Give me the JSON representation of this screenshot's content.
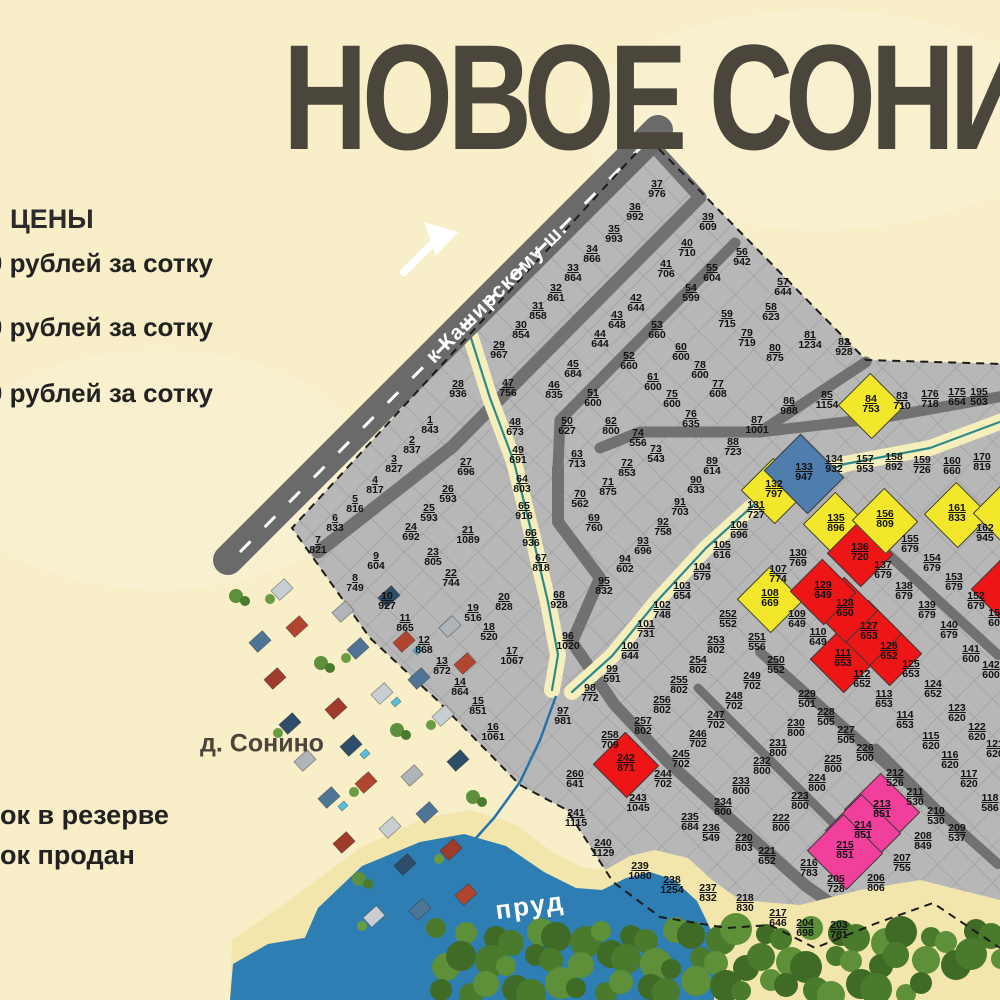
{
  "title": "НОВОЕ СОНИНО",
  "legend": {
    "heading": "ЦЕНЫ",
    "price_lines": [
      "00 рублей за сотку",
      "00 рублей за сотку",
      "0 рублей за сотку"
    ],
    "status_lines": [
      "ок в резерве",
      "ок продан"
    ]
  },
  "map_labels": {
    "road": "к Каширскому ш.",
    "village": "д. Сонино",
    "pond": "пруд"
  },
  "plot_colors": {
    "g": "#b7b7b7",
    "y": "#f2e72b",
    "r": "#ed1515",
    "b": "#4f7dad",
    "p": "#f0409c"
  },
  "edge_shards": [
    [
      1004,
      588,
      "r"
    ],
    [
      1006,
      512,
      "y"
    ]
  ],
  "plots": [
    [
      "1",
      "843",
      430,
      425
    ],
    [
      "2",
      "837",
      412,
      445
    ],
    [
      "3",
      "827",
      394,
      464
    ],
    [
      "4",
      "817",
      375,
      485
    ],
    [
      "5",
      "816",
      355,
      504
    ],
    [
      "6",
      "833",
      335,
      523
    ],
    [
      "7",
      "821",
      318,
      545
    ],
    [
      "8",
      "749",
      355,
      583
    ],
    [
      "9",
      "604",
      376,
      561
    ],
    [
      "10",
      "927",
      387,
      601
    ],
    [
      "11",
      "865",
      405,
      623
    ],
    [
      "12",
      "868",
      424,
      645
    ],
    [
      "13",
      "872",
      442,
      666
    ],
    [
      "14",
      "864",
      460,
      687
    ],
    [
      "15",
      "851",
      478,
      706
    ],
    [
      "16",
      "1061",
      493,
      732
    ],
    [
      "17",
      "1067",
      512,
      656
    ],
    [
      "18",
      "520",
      489,
      632
    ],
    [
      "19",
      "516",
      473,
      613
    ],
    [
      "20",
      "828",
      504,
      602
    ],
    [
      "21",
      "1089",
      468,
      535
    ],
    [
      "22",
      "744",
      451,
      578
    ],
    [
      "23",
      "805",
      433,
      557
    ],
    [
      "24",
      "692",
      411,
      532
    ],
    [
      "25",
      "593",
      429,
      513
    ],
    [
      "26",
      "593",
      448,
      494
    ],
    [
      "27",
      "696",
      466,
      467
    ],
    [
      "28",
      "936",
      458,
      389
    ],
    [
      "29",
      "967",
      499,
      350
    ],
    [
      "30",
      "854",
      521,
      330
    ],
    [
      "31",
      "858",
      538,
      311
    ],
    [
      "32",
      "861",
      556,
      293
    ],
    [
      "33",
      "864",
      573,
      273
    ],
    [
      "34",
      "866",
      592,
      254
    ],
    [
      "35",
      "993",
      614,
      234
    ],
    [
      "36",
      "992",
      635,
      212
    ],
    [
      "37",
      "976",
      657,
      189
    ],
    [
      "39",
      "609",
      708,
      222
    ],
    [
      "40",
      "710",
      687,
      248
    ],
    [
      "41",
      "706",
      666,
      269
    ],
    [
      "42",
      "644",
      636,
      303
    ],
    [
      "43",
      "648",
      617,
      320
    ],
    [
      "44",
      "644",
      600,
      339
    ],
    [
      "45",
      "684",
      573,
      369
    ],
    [
      "46",
      "835",
      554,
      390
    ],
    [
      "47",
      "756",
      508,
      388
    ],
    [
      "48",
      "673",
      515,
      427
    ],
    [
      "49",
      "691",
      518,
      455
    ],
    [
      "50",
      "627",
      567,
      426
    ],
    [
      "51",
      "600",
      593,
      398
    ],
    [
      "52",
      "660",
      629,
      361
    ],
    [
      "53",
      "660",
      657,
      330
    ],
    [
      "54",
      "599",
      691,
      293
    ],
    [
      "55",
      "604",
      712,
      273
    ],
    [
      "56",
      "942",
      742,
      257
    ],
    [
      "57",
      "644",
      783,
      287
    ],
    [
      "58",
      "623",
      771,
      312
    ],
    [
      "59",
      "715",
      727,
      319
    ],
    [
      "60",
      "600",
      681,
      352
    ],
    [
      "61",
      "600",
      653,
      382
    ],
    [
      "62",
      "800",
      611,
      426
    ],
    [
      "63",
      "713",
      577,
      459
    ],
    [
      "64",
      "803",
      522,
      484
    ],
    [
      "65",
      "916",
      524,
      511
    ],
    [
      "66",
      "936",
      531,
      538
    ],
    [
      "67",
      "818",
      541,
      563
    ],
    [
      "68",
      "928",
      559,
      600
    ],
    [
      "69",
      "760",
      594,
      523
    ],
    [
      "70",
      "562",
      580,
      499
    ],
    [
      "71",
      "875",
      608,
      487
    ],
    [
      "72",
      "853",
      627,
      468
    ],
    [
      "73",
      "543",
      656,
      454
    ],
    [
      "74",
      "556",
      638,
      438
    ],
    [
      "75",
      "600",
      672,
      399
    ],
    [
      "76",
      "635",
      691,
      419
    ],
    [
      "77",
      "608",
      718,
      389
    ],
    [
      "78",
      "600",
      700,
      370
    ],
    [
      "79",
      "719",
      747,
      338
    ],
    [
      "80",
      "875",
      775,
      353
    ],
    [
      "81",
      "1234",
      810,
      340
    ],
    [
      "82",
      "928",
      844,
      347
    ],
    [
      "83",
      "710",
      902,
      401
    ],
    [
      "84",
      "753",
      871,
      404,
      "y"
    ],
    [
      "85",
      "1154",
      827,
      400
    ],
    [
      "86",
      "988",
      789,
      406
    ],
    [
      "87",
      "1001",
      757,
      425
    ],
    [
      "88",
      "723",
      733,
      447
    ],
    [
      "89",
      "614",
      712,
      466
    ],
    [
      "90",
      "633",
      696,
      485
    ],
    [
      "91",
      "703",
      680,
      507
    ],
    [
      "92",
      "758",
      663,
      527
    ],
    [
      "93",
      "696",
      643,
      546
    ],
    [
      "94",
      "602",
      625,
      564
    ],
    [
      "95",
      "832",
      604,
      586
    ],
    [
      "96",
      "1020",
      568,
      641
    ],
    [
      "97",
      "981",
      563,
      716
    ],
    [
      "98",
      "772",
      590,
      693
    ],
    [
      "99",
      "591",
      612,
      674
    ],
    [
      "100",
      "644",
      630,
      651
    ],
    [
      "101",
      "731",
      646,
      629
    ],
    [
      "102",
      "748",
      662,
      610
    ],
    [
      "103",
      "654",
      682,
      591
    ],
    [
      "104",
      "579",
      702,
      572
    ],
    [
      "105",
      "616",
      722,
      550
    ],
    [
      "106",
      "696",
      739,
      530
    ],
    [
      "107",
      "774",
      778,
      574
    ],
    [
      "108",
      "669",
      770,
      598,
      "y"
    ],
    [
      "109",
      "649",
      797,
      619
    ],
    [
      "110",
      "649",
      818,
      637
    ],
    [
      "111",
      "653",
      843,
      658,
      "r"
    ],
    [
      "112",
      "652",
      862,
      679
    ],
    [
      "113",
      "653",
      884,
      699
    ],
    [
      "114",
      "653",
      905,
      720
    ],
    [
      "115",
      "620",
      931,
      741
    ],
    [
      "116",
      "620",
      950,
      760
    ],
    [
      "117",
      "620",
      969,
      779
    ],
    [
      "118",
      "586",
      990,
      803
    ],
    [
      "121",
      "620",
      995,
      749
    ],
    [
      "122",
      "620",
      977,
      732
    ],
    [
      "123",
      "620",
      957,
      713
    ],
    [
      "124",
      "652",
      933,
      689
    ],
    [
      "125",
      "653",
      911,
      669
    ],
    [
      "126",
      "652",
      889,
      651,
      "r"
    ],
    [
      "127",
      "653",
      869,
      631,
      "r"
    ],
    [
      "128",
      "650",
      845,
      608,
      "r"
    ],
    [
      "129",
      "649",
      823,
      590,
      "r"
    ],
    [
      "130",
      "769",
      798,
      558
    ],
    [
      "131",
      "727",
      756,
      510
    ],
    [
      "132",
      "797",
      774,
      489,
      "y"
    ],
    [
      "133",
      "947",
      804,
      472,
      "b"
    ],
    [
      "134",
      "932",
      834,
      464
    ],
    [
      "135",
      "896",
      836,
      523,
      "y"
    ],
    [
      "136",
      "720",
      860,
      552,
      "r"
    ],
    [
      "137",
      "679",
      883,
      570
    ],
    [
      "138",
      "679",
      904,
      591
    ],
    [
      "139",
      "679",
      927,
      610
    ],
    [
      "140",
      "679",
      949,
      630
    ],
    [
      "141",
      "600",
      971,
      654
    ],
    [
      "142",
      "600",
      991,
      670
    ],
    [
      "151",
      "600",
      997,
      618
    ],
    [
      "152",
      "679",
      976,
      601
    ],
    [
      "153",
      "679",
      954,
      582
    ],
    [
      "154",
      "679",
      932,
      563
    ],
    [
      "155",
      "679",
      910,
      544
    ],
    [
      "156",
      "809",
      885,
      519,
      "y"
    ],
    [
      "157",
      "953",
      865,
      464
    ],
    [
      "158",
      "892",
      894,
      462
    ],
    [
      "159",
      "726",
      922,
      465
    ],
    [
      "160",
      "660",
      952,
      466
    ],
    [
      "161",
      "833",
      957,
      513,
      "y"
    ],
    [
      "162",
      "945",
      985,
      533
    ],
    [
      "170",
      "819",
      982,
      462
    ],
    [
      "175",
      "654",
      957,
      397
    ],
    [
      "176",
      "718",
      930,
      399
    ],
    [
      "195",
      "503",
      979,
      397
    ],
    [
      "203",
      "781",
      839,
      930
    ],
    [
      "204",
      "698",
      805,
      928
    ],
    [
      "205",
      "728",
      836,
      884
    ],
    [
      "206",
      "806",
      876,
      883
    ],
    [
      "207",
      "755",
      902,
      863
    ],
    [
      "208",
      "849",
      923,
      841
    ],
    [
      "209",
      "537",
      957,
      833
    ],
    [
      "210",
      "530",
      936,
      816
    ],
    [
      "211",
      "530",
      915,
      797
    ],
    [
      "212",
      "526",
      895,
      778
    ],
    [
      "213",
      "851",
      882,
      809,
      "p"
    ],
    [
      "214",
      "851",
      863,
      830,
      "p"
    ],
    [
      "215",
      "851",
      845,
      850,
      "p"
    ],
    [
      "216",
      "783",
      809,
      868
    ],
    [
      "217",
      "646",
      778,
      918
    ],
    [
      "218",
      "830",
      745,
      903
    ],
    [
      "220",
      "803",
      744,
      843
    ],
    [
      "221",
      "652",
      767,
      856
    ],
    [
      "222",
      "800",
      781,
      823
    ],
    [
      "223",
      "800",
      800,
      801
    ],
    [
      "224",
      "800",
      817,
      783
    ],
    [
      "225",
      "800",
      833,
      764
    ],
    [
      "226",
      "500",
      865,
      753
    ],
    [
      "227",
      "505",
      846,
      735
    ],
    [
      "228",
      "505",
      826,
      717
    ],
    [
      "229",
      "501",
      807,
      699
    ],
    [
      "230",
      "800",
      796,
      728
    ],
    [
      "231",
      "800",
      778,
      748
    ],
    [
      "232",
      "800",
      762,
      766
    ],
    [
      "233",
      "800",
      741,
      786
    ],
    [
      "234",
      "800",
      723,
      807
    ],
    [
      "235",
      "684",
      690,
      822
    ],
    [
      "236",
      "549",
      711,
      833
    ],
    [
      "237",
      "832",
      708,
      893
    ],
    [
      "238",
      "1254",
      672,
      885
    ],
    [
      "239",
      "1080",
      640,
      871
    ],
    [
      "240",
      "1129",
      603,
      848
    ],
    [
      "241",
      "1115",
      576,
      818
    ],
    [
      "242",
      "871",
      626,
      763,
      "r"
    ],
    [
      "243",
      "1045",
      638,
      803
    ],
    [
      "244",
      "702",
      663,
      779
    ],
    [
      "245",
      "702",
      681,
      759
    ],
    [
      "246",
      "702",
      698,
      739
    ],
    [
      "247",
      "702",
      716,
      720
    ],
    [
      "248",
      "702",
      734,
      701
    ],
    [
      "249",
      "702",
      752,
      681
    ],
    [
      "250",
      "552",
      776,
      665
    ],
    [
      "251",
      "556",
      757,
      642
    ],
    [
      "252",
      "552",
      728,
      619
    ],
    [
      "253",
      "802",
      716,
      645
    ],
    [
      "254",
      "802",
      698,
      665
    ],
    [
      "255",
      "802",
      679,
      685
    ],
    [
      "256",
      "802",
      662,
      705
    ],
    [
      "257",
      "802",
      643,
      726
    ],
    [
      "258",
      "709",
      610,
      740
    ],
    [
      "260",
      "641",
      575,
      779
    ]
  ]
}
